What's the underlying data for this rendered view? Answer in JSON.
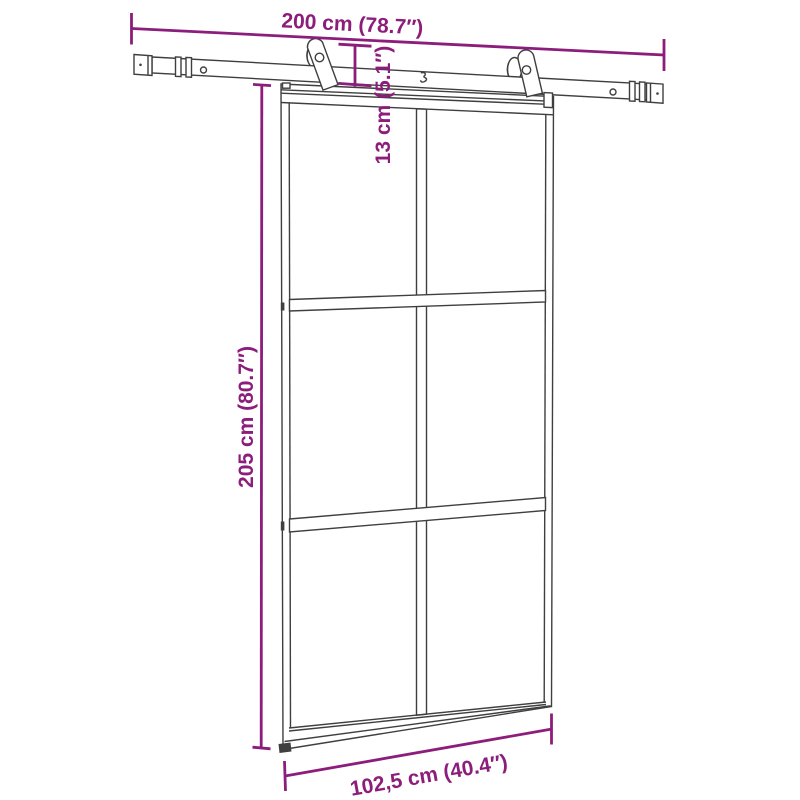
{
  "figure": {
    "subject": "sliding glass door hanging from a barn-style top track with two rollers",
    "view": "product dimension diagram",
    "glass_grid": {
      "columns": 2,
      "rows": 3
    }
  },
  "colors": {
    "background": "#FFFFFF",
    "drawing_line": "#3F3F3F",
    "dimension_accent": "#8C1D7B"
  },
  "dimensions": {
    "track_width": "200 cm (78.7″)",
    "top_clearance": "13 cm (5.1″)",
    "door_height": "205 cm (80.7″)",
    "door_width": "102,5 cm (40.4″)"
  }
}
